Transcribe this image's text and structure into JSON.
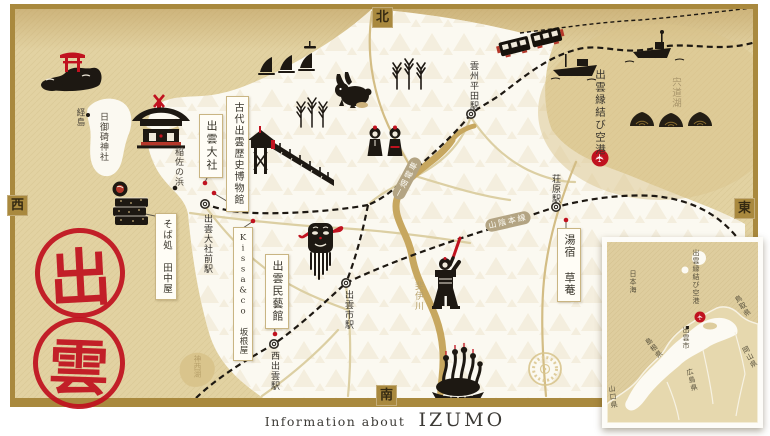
{
  "poster": {
    "caption_prefix": "Information about",
    "caption_title": "IZUMO"
  },
  "compass": {
    "north": "北",
    "south": "南",
    "east": "東",
    "west": "西"
  },
  "seal": {
    "top": "出",
    "bottom": "雲"
  },
  "colors": {
    "accent_red": "#c0121f",
    "frame_gold": "#a9893e",
    "sea_tan": "#e2d2a2",
    "land_white": "#fbf9f1",
    "ink": "#1d1812"
  },
  "landmarks": {
    "museum": "古代出雲歴史博物館",
    "taisha": "出雲大社",
    "tanakaya": "そば処 田中屋",
    "kissa": "Kissa&co 坂根屋",
    "mingeikan": "出雲民藝館",
    "soan": "湯宿 草菴",
    "airport": "出雲縁結び空港"
  },
  "stations": {
    "unshu_hirata": "雲州平田駅",
    "taisha_mae": "出雲大社前駅",
    "shobara": "荘原駅",
    "izumoshi": "出雲市駅",
    "nishi_izumo": "西出雲駅"
  },
  "geography": {
    "fumishima": "経島",
    "hinomisaki": "日御碕神社",
    "inasa_no_hama": "稲佐の浜",
    "lake_shinji": "宍道湖",
    "hii_river": "斐伊川",
    "lake_jinzai": "神西湖"
  },
  "rail_lines": {
    "ichibata": "一畑電車",
    "sanin": "山陰本線"
  },
  "inset": {
    "sea": "日本海",
    "airport": "出雲縁結び空港",
    "city": "出雲市",
    "prefectures": {
      "shimane": "島根県",
      "tottori": "鳥取県",
      "okayama": "岡山県",
      "hiroshima": "広島県",
      "yamaguchi": "山口県"
    }
  }
}
